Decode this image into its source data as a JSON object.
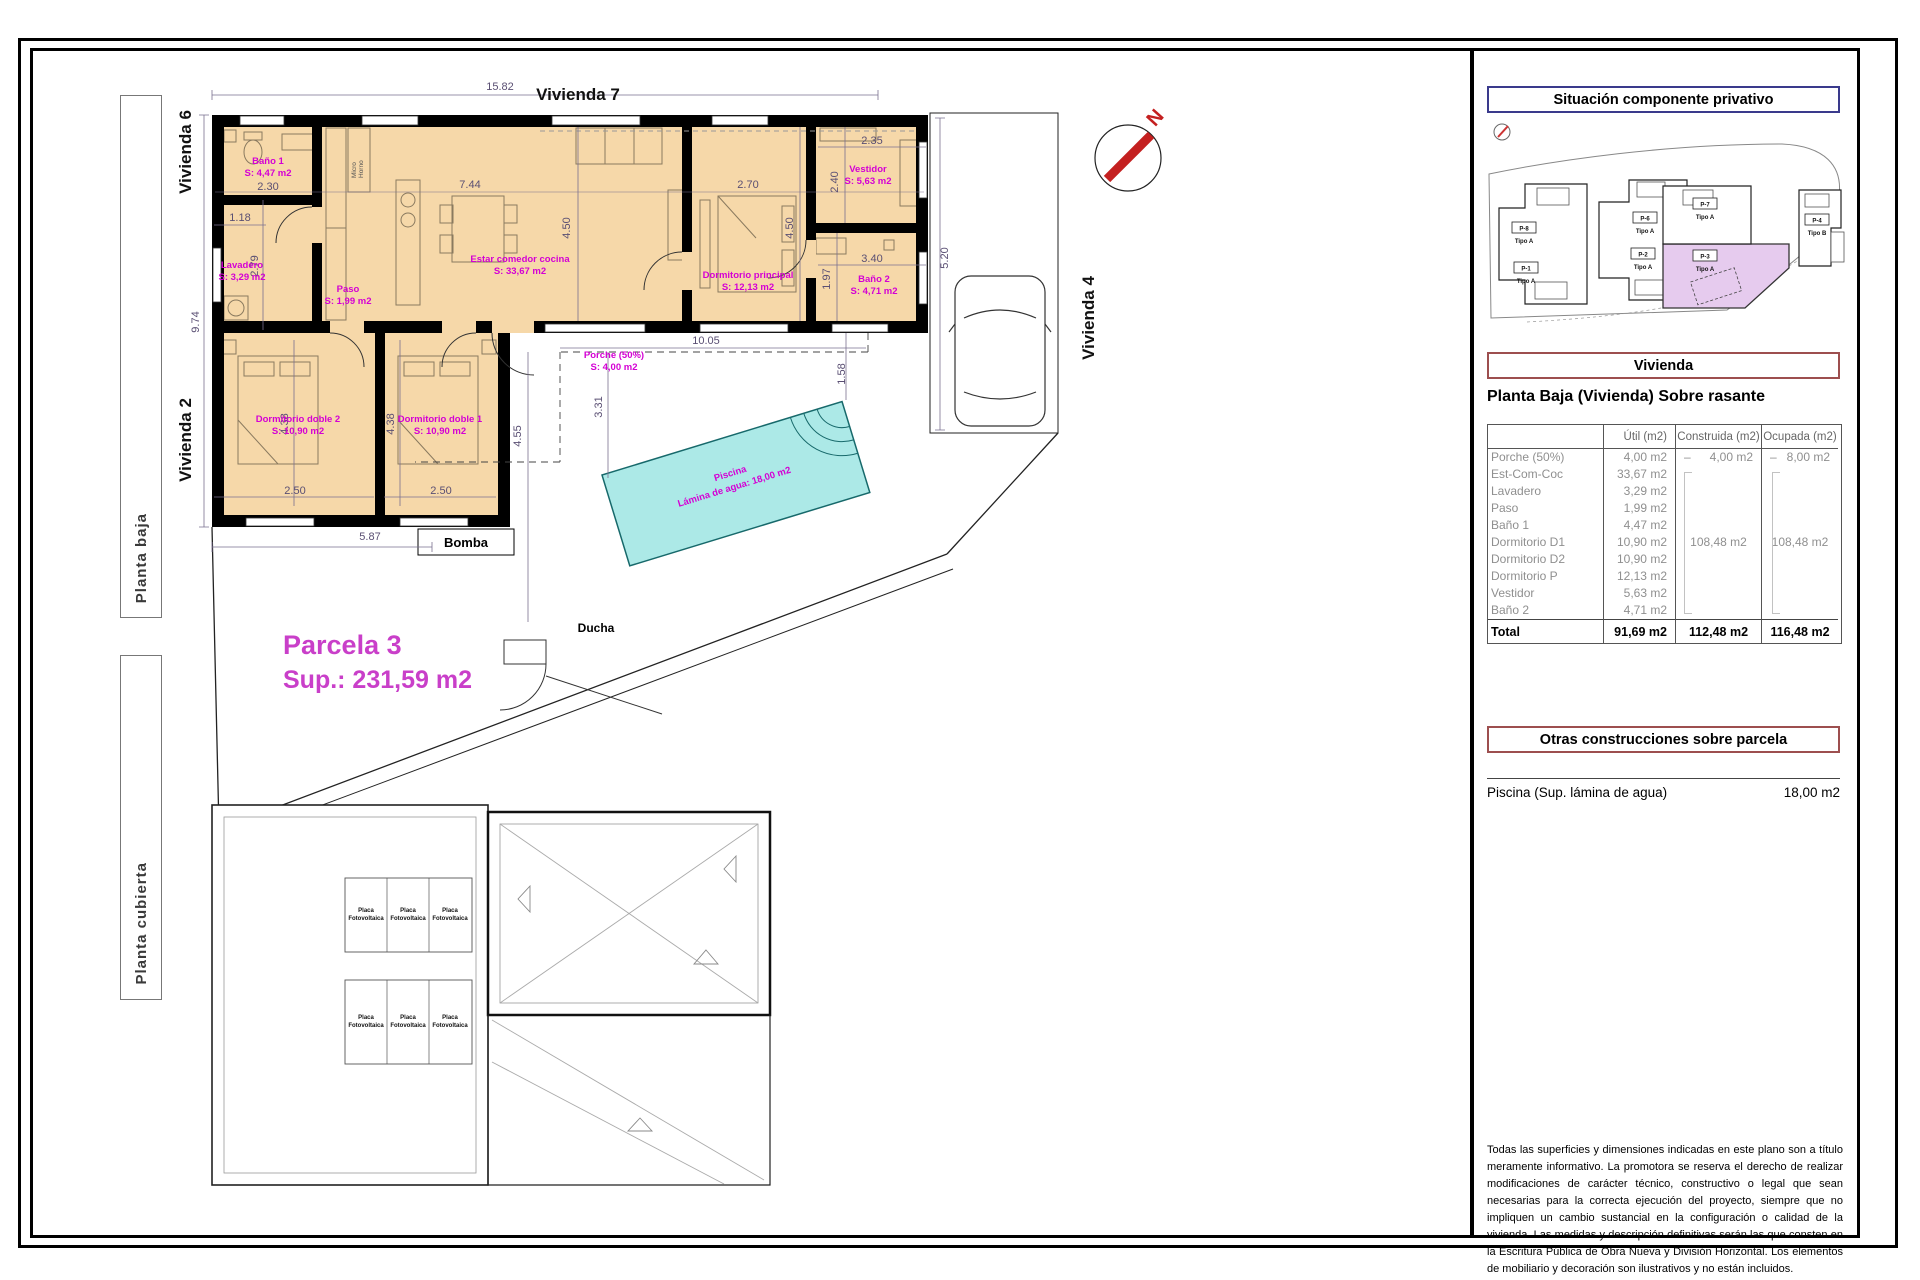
{
  "tabs": [
    {
      "label": "Planta baja"
    },
    {
      "label": "Planta cubierta"
    }
  ],
  "plan": {
    "neighbors": {
      "top": "Vivienda 7",
      "left_upper": "Vivienda 6",
      "left_lower": "Vivienda 2",
      "right": "Vivienda 4"
    },
    "parcel": {
      "name": "Parcela 3",
      "area": "Sup.: 231,59 m2"
    },
    "rooms": {
      "bano1": {
        "name": "Baño 1",
        "area": "S: 4,47 m2"
      },
      "lavadero": {
        "name": "Lavadero",
        "area": "S: 3,29 m2"
      },
      "paso": {
        "name": "Paso",
        "area": "S: 1,99 m2"
      },
      "estar": {
        "name": "Estar comedor cocina",
        "area": "S: 33,67 m2"
      },
      "dormitorio_principal": {
        "name": "Dormitorio principal",
        "area": "S: 12,13 m2"
      },
      "vestidor": {
        "name": "Vestidor",
        "area": "S: 5,63 m2"
      },
      "bano2": {
        "name": "Baño 2",
        "area": "S: 4,71 m2"
      },
      "dormitorio_doble2": {
        "name": "Dormitorio doble 2",
        "area": "S: 10,90 m2"
      },
      "dormitorio_doble1": {
        "name": "Dormitorio doble 1",
        "area": "S: 10,90 m2"
      },
      "porche": {
        "name": "Porche (50%)",
        "area": "S: 4,00 m2"
      },
      "piscina": {
        "name": "Piscina",
        "area": "Lámina de agua: 18,00 m2"
      }
    },
    "annotations": {
      "bomba": "Bomba",
      "ducha": "Ducha",
      "micro": "Micro",
      "horno": "Horno",
      "north": "N"
    },
    "dims": {
      "d1582": "15.82",
      "d974": "9.74",
      "d230": "2.30",
      "d118": "1.18",
      "d279": "2.79",
      "d744": "7.44",
      "d450a": "4.50",
      "d270": "2.70",
      "d450b": "4.50",
      "d235": "2.35",
      "d240": "2.40",
      "d340": "3.40",
      "d197": "1.97",
      "d520": "5.20",
      "d1005": "10.05",
      "d158": "1.58",
      "d331": "3.31",
      "d455": "4.55",
      "d438a": "4.38",
      "d438b": "4.38",
      "d250a": "2.50",
      "d250b": "2.50",
      "d587": "5.87"
    }
  },
  "roof": {
    "panel_line1": "Placa",
    "panel_line2": "Fotovoltaica"
  },
  "panel": {
    "situacion": {
      "title": "Situación componente privativo",
      "units": [
        {
          "id": "P-8",
          "tipo": "Tipo A"
        },
        {
          "id": "P-1",
          "tipo": "Tipo A"
        },
        {
          "id": "P-6",
          "tipo": "Tipo A"
        },
        {
          "id": "P-2",
          "tipo": "Tipo A"
        },
        {
          "id": "P-7",
          "tipo": "Tipo A"
        },
        {
          "id": "P-3",
          "tipo": "Tipo A"
        },
        {
          "id": "P-4",
          "tipo": "Tipo B"
        }
      ]
    },
    "vivienda": {
      "title": "Vivienda",
      "subtitle": "Planta Baja (Vivienda) Sobre rasante",
      "col_util": "Útil (m2)",
      "col_construida": "Construida (m2)",
      "col_ocupada": "Ocupada (m2)",
      "rows": [
        {
          "name": "Porche (50%)",
          "util": "4,00 m2",
          "construida_dash": "–",
          "construida": "4,00 m2",
          "ocupada_dash": "–",
          "ocupada": "8,00 m2"
        },
        {
          "name": "Est-Com-Coc",
          "util": "33,67 m2"
        },
        {
          "name": "Lavadero",
          "util": "3,29 m2"
        },
        {
          "name": "Paso",
          "util": "1,99 m2"
        },
        {
          "name": "Baño 1",
          "util": "4,47 m2"
        },
        {
          "name": "Dormitorio D1",
          "util": "10,90 m2",
          "construida": "108,48 m2",
          "ocupada": "108,48 m2"
        },
        {
          "name": "Dormitorio D2",
          "util": "10,90 m2"
        },
        {
          "name": "Dormitorio P",
          "util": "12,13 m2"
        },
        {
          "name": "Vestidor",
          "util": "5,63 m2"
        },
        {
          "name": "Baño 2",
          "util": "4,71 m2"
        }
      ],
      "total": {
        "label": "Total",
        "util": "91,69 m2",
        "construida": "112,48 m2",
        "ocupada": "116,48 m2"
      }
    },
    "otras": {
      "title": "Otras construcciones sobre parcela",
      "item": "Piscina (Sup. lámina de agua)",
      "value": "18,00 m2"
    },
    "disclaimer": "Todas las superficies y dimensiones indicadas en este plano son a título meramente informativo. La promotora se reserva el derecho de realizar modificaciones de carácter técnico, constructivo o legal que sean necesarias para la correcta ejecución del proyecto, siempre que no impliquen un cambio sustancial en la configuración o calidad de la vivienda. Las medidas y descripción definitivas serán las que consten en la Escritura Pública de Obra Nueva y División Horizontal. Los elementos de mobiliario y decoración son ilustrativos y no están incluidos."
  }
}
